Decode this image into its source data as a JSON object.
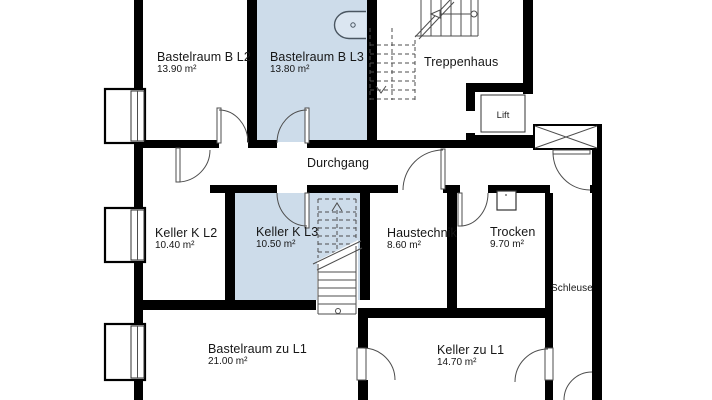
{
  "rooms": {
    "bastelraum_b_l2": {
      "name": "Bastelraum B L2",
      "area": "13.90 m²",
      "highlighted": false
    },
    "bastelraum_b_l3": {
      "name": "Bastelraum B L3",
      "area": "13.80 m²",
      "highlighted": true
    },
    "treppenhaus": {
      "name": "Treppenhaus",
      "highlighted": false
    },
    "lift": {
      "name": "Lift",
      "highlighted": false
    },
    "durchgang": {
      "name": "Durchgang",
      "highlighted": false
    },
    "keller_k_l2": {
      "name": "Keller K L2",
      "area": "10.40 m²",
      "highlighted": false
    },
    "keller_k_l3": {
      "name": "Keller K L3",
      "area": "10.50 m²",
      "highlighted": true
    },
    "haustechnik": {
      "name": "Haustechnik",
      "area": "8.60 m²",
      "highlighted": false
    },
    "trocken": {
      "name": "Trocken",
      "area": "9.70 m²",
      "highlighted": false
    },
    "schleuse": {
      "name": "Schleuse",
      "highlighted": false
    },
    "bastelraum_zu_l1": {
      "name": "Bastelraum zu L1",
      "area": "21.00 m²",
      "highlighted": false
    },
    "keller_zu_l1": {
      "name": "Keller zu L1",
      "area": "14.70 m²",
      "highlighted": false
    }
  },
  "colors": {
    "highlight": "#cddcea",
    "wall": "#000000",
    "line": "#4d4d4d",
    "background": "#ffffff"
  }
}
